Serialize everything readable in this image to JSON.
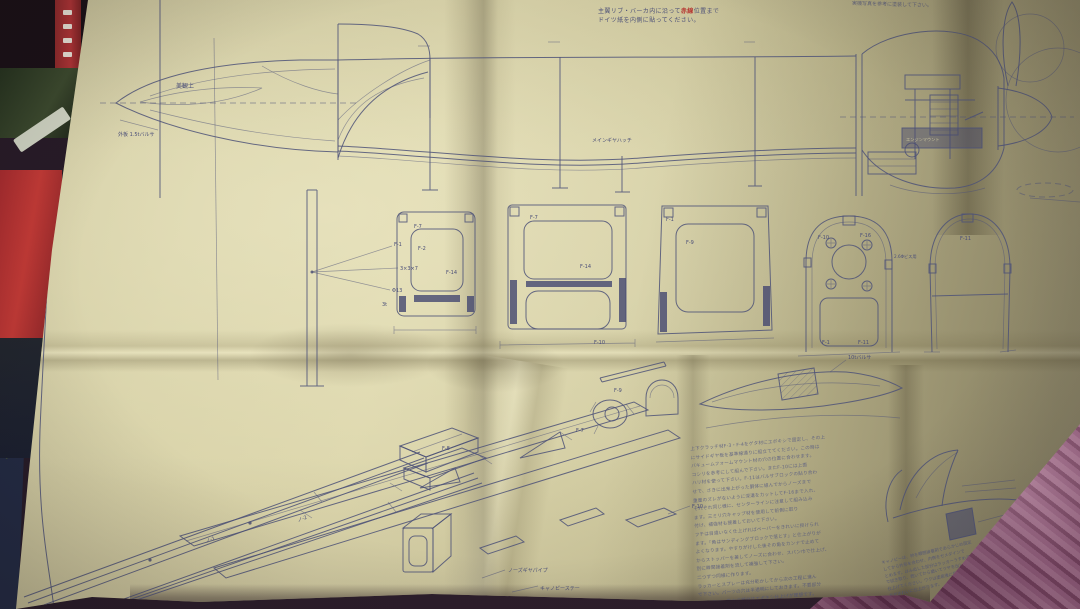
{
  "meta": {
    "description": "Photo of a folded Japanese model-aircraft construction plan (blueprint) lying on fabric"
  },
  "colors": {
    "paper": "#d6d0a6",
    "ink": "#4e5278",
    "fabric_pink": "#9c6384",
    "fabric_dark": "#241a26",
    "accent_red": "#b53530"
  },
  "top_note": {
    "line1_pre": "主翼リブ・バーカ内に沿って",
    "line1_red": "赤線",
    "line1_post": "位置まで",
    "line2": "ドイツ紙を内側に貼ってください。"
  },
  "top_right_note": "実機写真を参考に塗装して下さい。",
  "labels": {
    "surface": "美観上",
    "nose_note": "外板 1.5tバルサ",
    "fm": "F-1",
    "dim1": "3×3×7",
    "dim2": "Φ13",
    "dim3": "3t",
    "fuselage": "メインギヤハッチ",
    "engine_box": "エンジンマウント",
    "mount_note": "2.6Φビス用",
    "f7a": "F-7",
    "f14a": "F-14",
    "f2a": "F-2",
    "f7b": "F-7",
    "f14b": "F-14",
    "f10a": "F-10",
    "f9c": "F-9",
    "f1c": "F-1",
    "f10d": "F-10",
    "f16d": "F-16",
    "f1d": "F-1",
    "f11d": "F-11",
    "f11e": "F-11",
    "fin_note": "10tバルサ",
    "crutchA": "F-8",
    "crutchB": "F-9",
    "crutchC": "F-10",
    "crutchD": "F-7",
    "railA": "ノ-1",
    "railB": "ノ-2",
    "gear_pipe": "ノーズギヤパイプ",
    "canopy_stay": "キャノピーステー",
    "sketch_note": "ストッパー"
  },
  "instructions": {
    "lines": [
      "上下クラッチ材F-3・F-4をゲタ材にエポキシで固定し、その上",
      "にサイドギヤ板を基準線通りに組立ててください。この時は",
      "バキュームフォームマウント材の穴の位置に合わせます。",
      "コシリを参考にして組んで下さい。またF-10には上面",
      "ハリ材を使って下さい。F-11はバルサブロックの貼り合わ",
      "せで、さきに出来上がった胴体に組んでからノーズまで",
      "重量のズレがないように深溝をカットしてF-16まで入れ、",
      "それぞれ同じ様に、センターラインに注意して組み込み",
      "ます。三ミリ穴キャップ材を使用して前側に取り",
      "付け、補強材も接着しておいて下さい。",
      "フチは目違いなく仕上げればペーパーをきれいに掛けられ",
      "ます。「角はサンディングブロックで落とす」と仕上がりが",
      "よくなります。やすりがけした後その角をカンナで止めて",
      "からストッパーを差してノーズに合わせ、スパン巾で仕上げ、",
      "別に瞬間接着剤を流して補強して下さい。",
      "二つずつ同様に作ります。",
      "ラッカーとスプレーは充分乾かしてから次の工程に進ん",
      "で下さい。パーツの穴は半透明にしておきます。不要部分",
      "は切り取り、動かす部分はエポキシ仕上げが理想です。"
    ]
  },
  "corner_note": {
    "lines": [
      "キャノピーは、枠を瞬間接着剤であらかじめ固定",
      "してから外形を合わせ、内側をセメダインで",
      "とめます。はみ出した部分はラッカーうすめ液",
      "で拭き取り、乾いてから磨いてツヤを出して",
      "仕上げてください。ワクは塗装後に接着した",
      "方がきれいに仕上がります。"
    ]
  }
}
